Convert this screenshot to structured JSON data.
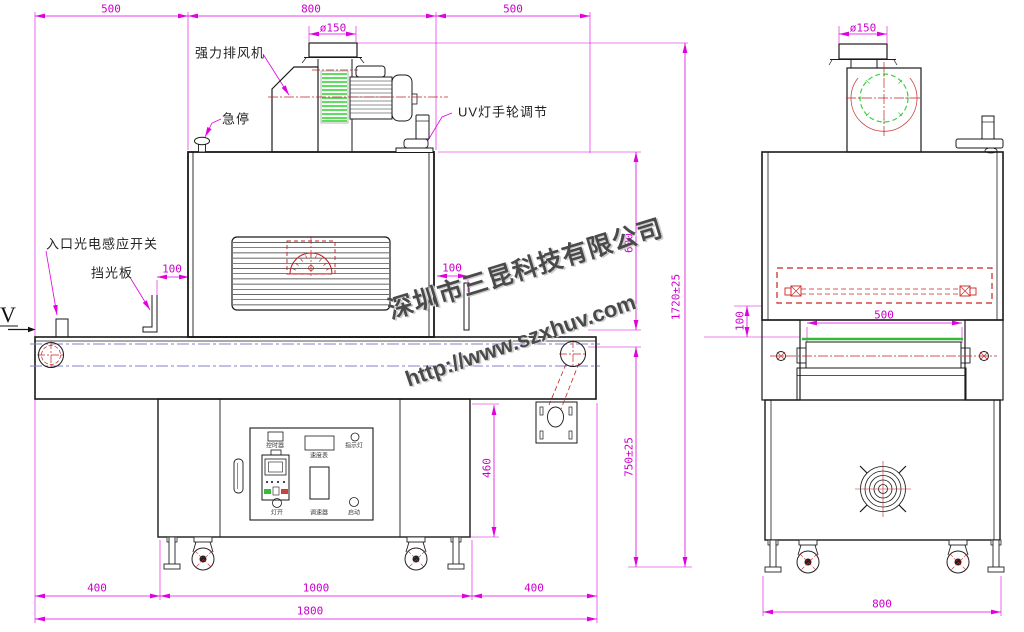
{
  "watermark": {
    "company": "深圳市三昆科技有限公司",
    "url": "http://www.szxhuv.com"
  },
  "front_view": {
    "callouts": {
      "exhaust_fan": "强力排风机",
      "emergency_stop": "急停",
      "uv_handwheel": "UV灯手轮调节",
      "entry_sensor": "入口光电感应开关",
      "light_shield": "挡光板",
      "feed_direction": "V"
    },
    "dimensions": {
      "top_left": "500",
      "top_middle": "800",
      "top_right": "500",
      "duct_diameter": "ø150",
      "shield_gap_left": "100",
      "shield_gap_right": "100",
      "lamp_house_height": "600",
      "total_height": "1720±25",
      "belt_height": "750±25",
      "stand_height": "460",
      "bottom_left": "400",
      "bottom_middle": "1000",
      "bottom_right": "400",
      "total_length": "1800"
    },
    "control_panel": {
      "timer": "控时器",
      "speed_meter": "速度表",
      "indicator_light": "指示灯",
      "lamp_switch": "灯开",
      "speed_knob": "调速器",
      "start_button": "启动"
    }
  },
  "side_view": {
    "dimensions": {
      "duct_diameter": "ø150",
      "lamp_to_belt": "100",
      "belt_width": "500",
      "overall_width": "800"
    }
  }
}
